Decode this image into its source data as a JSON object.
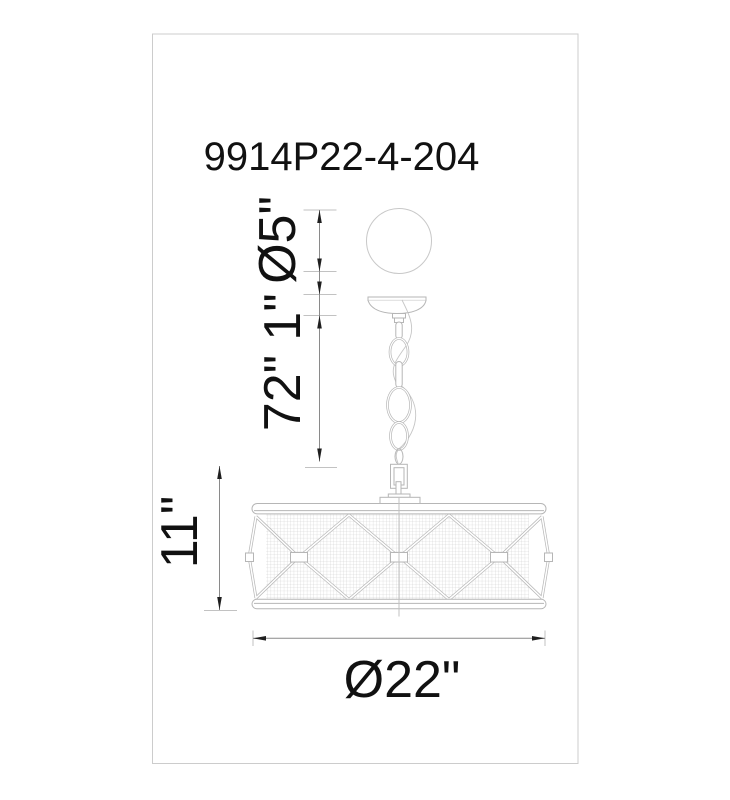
{
  "drawing": {
    "model_number": "9914P22-4-204",
    "dimensions": {
      "sphere_diameter": "Ø5\"",
      "canopy_height": "1\"",
      "chain_length": "72\"",
      "shade_height": "11\"",
      "shade_diameter": "Ø22\""
    },
    "colors": {
      "line": "#b6b6b6",
      "light_line": "#c8c8c8",
      "mesh": "#cdcdcd",
      "dimension_line": "#8a8a8a",
      "tick": "#c2c2c2",
      "arrow": "#1f1f1f",
      "text": "#111111",
      "frame": "#cccccc"
    }
  }
}
